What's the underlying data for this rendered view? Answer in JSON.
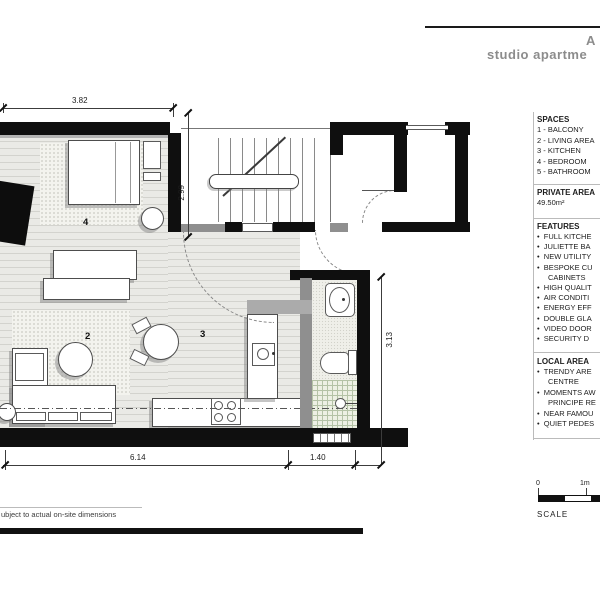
{
  "header": {
    "line1": "A",
    "line2": "studio apartme"
  },
  "panel": {
    "spaces": {
      "title": "SPACES",
      "items": [
        "1 - BALCONY",
        "2 - LIVING AREA",
        "3 - KITCHEN",
        "4 - BEDROOM",
        "5 - BATHROOM"
      ]
    },
    "private_area": {
      "title": "PRIVATE AREA",
      "value": "49.50m²"
    },
    "features": {
      "title": "FEATURES",
      "items": [
        "FULL KITCHE",
        "JULIETTE BA",
        "NEW UTILITY",
        "BESPOKE CU",
        "CABINETS",
        "HIGH QUALIT",
        "AIR CONDITI",
        "ENERGY EFF",
        "DOUBLE GLA",
        "VIDEO DOOR",
        "SECURITY D"
      ]
    },
    "local_area": {
      "title": "LOCAL AREA",
      "items": [
        "TRENDY ARE",
        "CENTRE",
        "MOMENTS AW",
        "PRINCIPE RE",
        "NEAR FAMOU",
        "QUIET PEDES"
      ]
    }
  },
  "plan": {
    "rooms": {
      "living": "2",
      "kitchen": "3",
      "bedroom": "4",
      "bathroom": "5"
    },
    "dimensions": {
      "top": "3.82",
      "stair_height": "2.99",
      "bath_height": "3.13",
      "bottom_main": "6.14",
      "bottom_bath": "1.40"
    }
  },
  "scale_bar": {
    "zero": "0",
    "one_meter": "1m",
    "label": "SCALE"
  },
  "footer": {
    "note": "ubject to actual on-site dimensions"
  },
  "colors": {
    "wall": "#0f0f0f",
    "title_gray": "#8c8c8c"
  }
}
